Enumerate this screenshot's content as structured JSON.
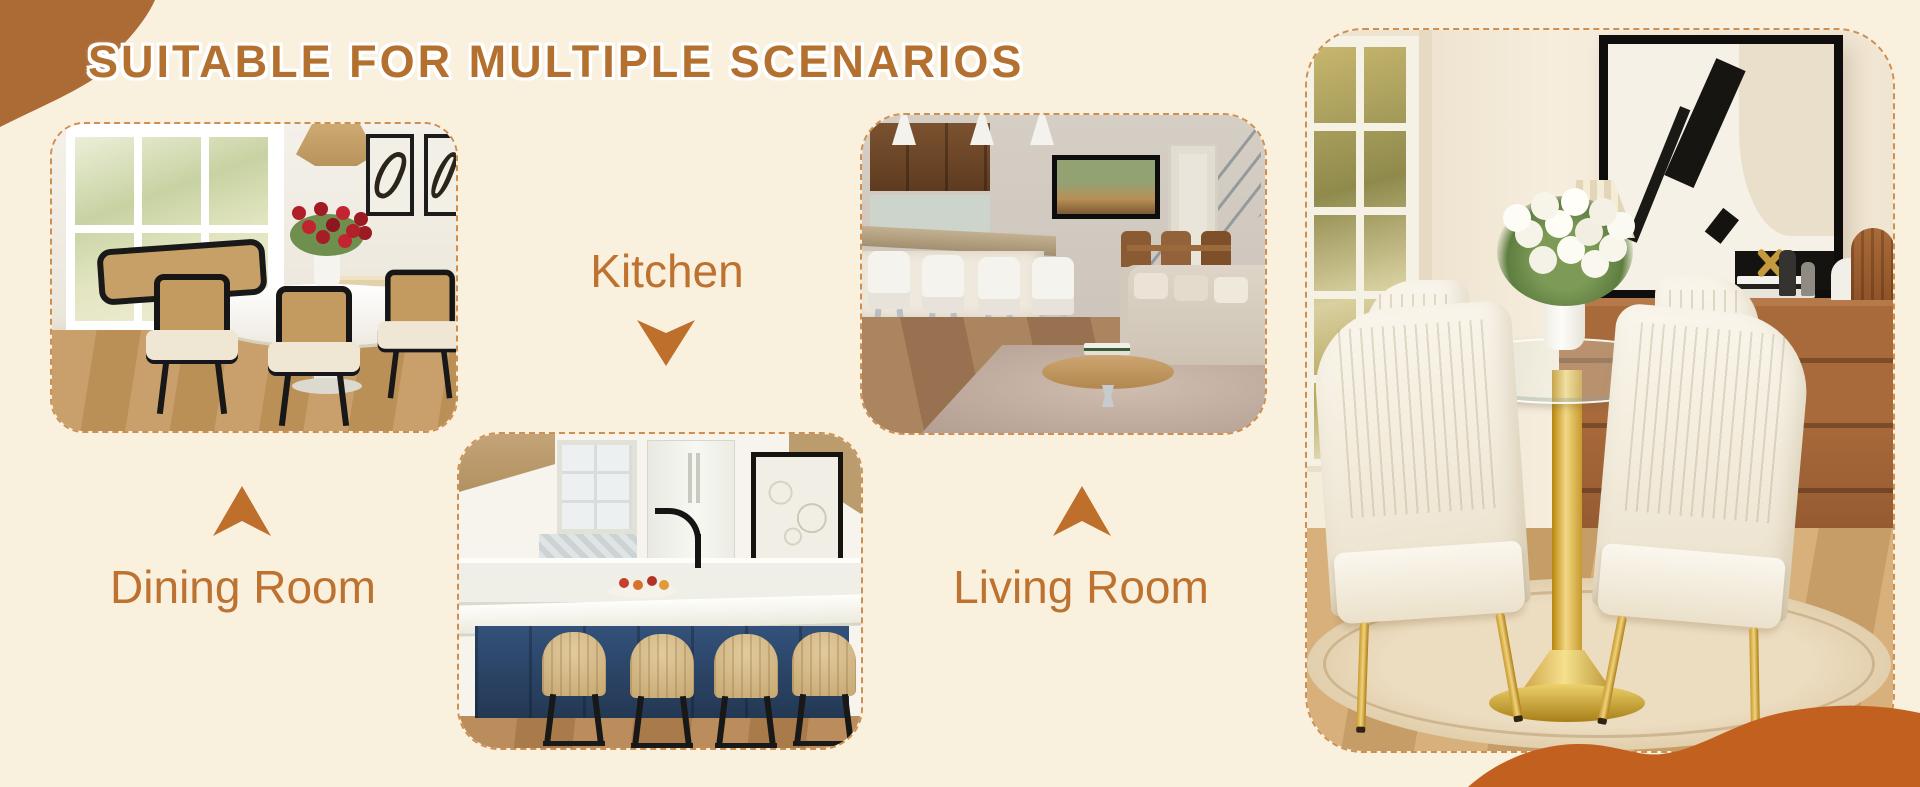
{
  "banner": {
    "title": "SUITABLE FOR MULTIPLE SCENARIOS",
    "scenarios": [
      {
        "id": "dining-room",
        "label": "Dining Room",
        "arrow_direction": "up",
        "photo_alt": "Dining room with a white oval table, black cane-back chairs, a red flower centerpiece, rattan pendant light and a large bright window"
      },
      {
        "id": "kitchen",
        "label": "Kitchen",
        "arrow_direction": "down",
        "photo_alt": "Kitchen with a navy blue island, white countertop, black faucet, framed art and four rattan bar stools"
      },
      {
        "id": "living-room",
        "label": "Living Room",
        "arrow_direction": "up",
        "photo_alt": "Open-plan living room with white counter stools, wall-mounted TV, staircase railing, beige sofa, oval coffee table and area rug"
      }
    ],
    "hero_photo_alt": "Round glass-top dining table with a gold tulip pedestal and four cream channel-stitched chairs with gold legs, styled with white tulips, abstract wall art, a pleated table lamp and a walnut sideboard on a round beige rug",
    "colors": {
      "page_background": "#FAF0DE",
      "accent_orange": "#B4702E",
      "label_orange": "#BD7230",
      "corner_blob": "#AC6A34",
      "bottom_wave": "#C2611F",
      "dashed_border": "#CE8F52"
    }
  }
}
